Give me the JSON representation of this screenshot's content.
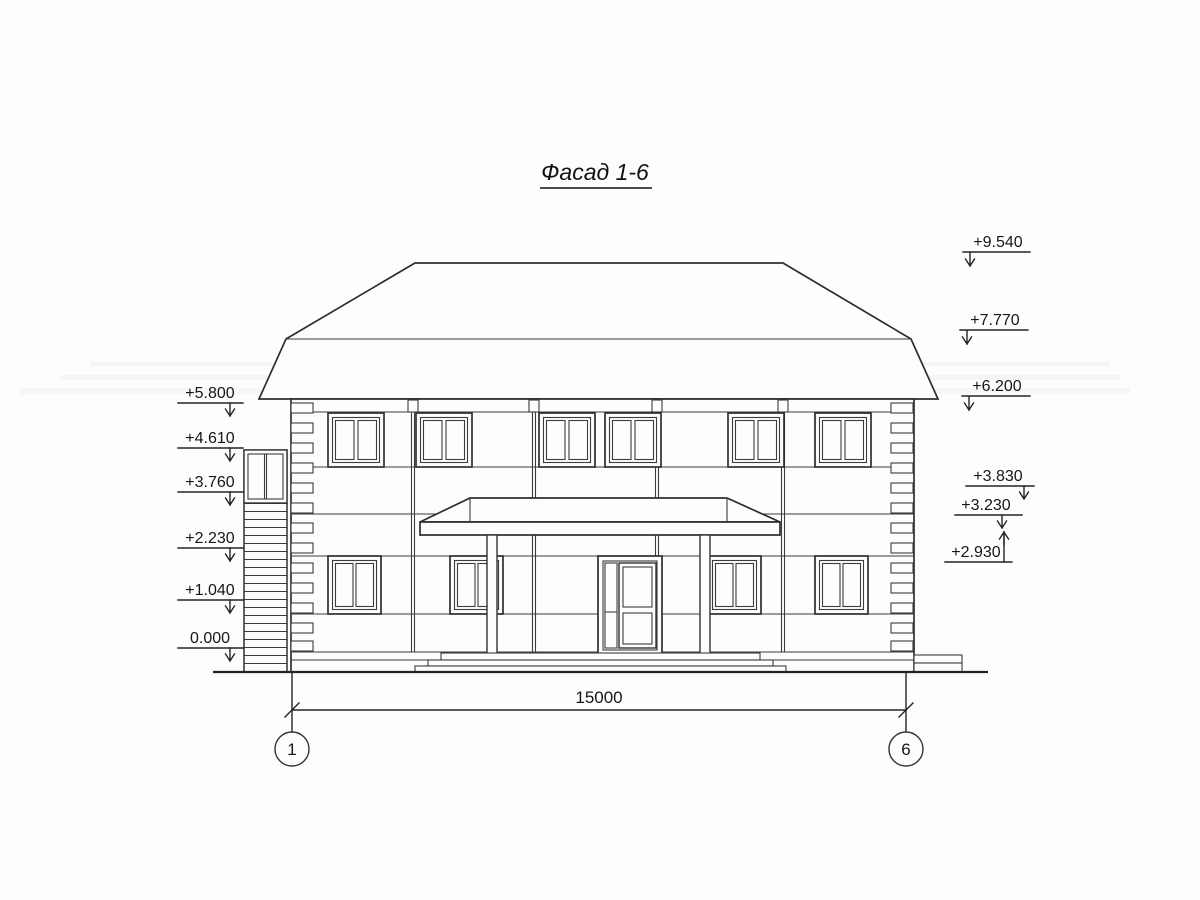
{
  "title": "Фасад 1-6",
  "marks": {
    "left": [
      "+5.800",
      "+4.610",
      "+3.760",
      "+2.230",
      "+1.040",
      "0.000"
    ],
    "right_upper": [
      "+9.540",
      "+7.770",
      "+6.200"
    ],
    "right_lower": [
      "+3.830",
      "+3.230",
      "+2.930"
    ]
  },
  "dimension": {
    "value": "15000"
  },
  "axes": [
    "1",
    "6"
  ],
  "colors": {
    "line": "#2e2e2e",
    "paper": "#fdfdfc"
  }
}
